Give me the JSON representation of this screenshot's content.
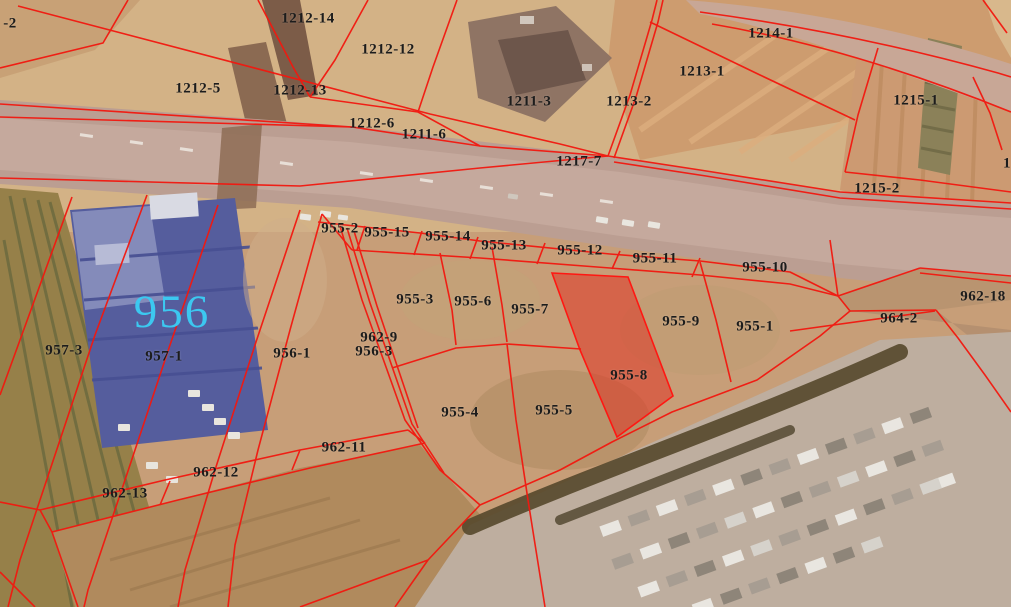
{
  "map": {
    "type": "cadastral-parcel-map-over-aerial-photo",
    "line_color": "#f2180f",
    "label_color": "#1c1c1c",
    "highlighted_parcel": "955-8",
    "highlight_fill": "#e03424",
    "area_label": {
      "text": "956",
      "color": "#3cc8f0",
      "x": 172,
      "y": 312
    },
    "labels": [
      {
        "text": "-2",
        "x": 10,
        "y": 24
      },
      {
        "text": "1212-14",
        "x": 308,
        "y": 19
      },
      {
        "text": "1212-12",
        "x": 388,
        "y": 50
      },
      {
        "text": "1212-5",
        "x": 198,
        "y": 89
      },
      {
        "text": "1212-13",
        "x": 300,
        "y": 91
      },
      {
        "text": "1212-6",
        "x": 372,
        "y": 124
      },
      {
        "text": "1211-6",
        "x": 424,
        "y": 135
      },
      {
        "text": "1211-3",
        "x": 529,
        "y": 102
      },
      {
        "text": "1213-2",
        "x": 629,
        "y": 102
      },
      {
        "text": "1213-1",
        "x": 702,
        "y": 72
      },
      {
        "text": "1214-1",
        "x": 771,
        "y": 34
      },
      {
        "text": "1215-1",
        "x": 916,
        "y": 101
      },
      {
        "text": "1217-7",
        "x": 579,
        "y": 162
      },
      {
        "text": "1215-2",
        "x": 877,
        "y": 189
      },
      {
        "text": "1",
        "x": 1007,
        "y": 164
      },
      {
        "text": "955-2",
        "x": 340,
        "y": 229
      },
      {
        "text": "955-15",
        "x": 387,
        "y": 233
      },
      {
        "text": "955-14",
        "x": 448,
        "y": 237
      },
      {
        "text": "955-13",
        "x": 504,
        "y": 246
      },
      {
        "text": "955-12",
        "x": 580,
        "y": 251
      },
      {
        "text": "955-11",
        "x": 655,
        "y": 259
      },
      {
        "text": "955-10",
        "x": 765,
        "y": 268
      },
      {
        "text": "955-3",
        "x": 415,
        "y": 300
      },
      {
        "text": "955-6",
        "x": 473,
        "y": 302
      },
      {
        "text": "955-7",
        "x": 530,
        "y": 310
      },
      {
        "text": "955-9",
        "x": 681,
        "y": 322
      },
      {
        "text": "955-1",
        "x": 755,
        "y": 327
      },
      {
        "text": "962-18",
        "x": 983,
        "y": 297
      },
      {
        "text": "964-2",
        "x": 899,
        "y": 319
      },
      {
        "text": "962-9",
        "x": 379,
        "y": 338
      },
      {
        "text": "956-3",
        "x": 374,
        "y": 352
      },
      {
        "text": "955-8",
        "x": 629,
        "y": 376
      },
      {
        "text": "955-4",
        "x": 460,
        "y": 413
      },
      {
        "text": "955-5",
        "x": 554,
        "y": 411
      },
      {
        "text": "957-3",
        "x": 64,
        "y": 351
      },
      {
        "text": "957-1",
        "x": 164,
        "y": 357
      },
      {
        "text": "956-1",
        "x": 292,
        "y": 354
      },
      {
        "text": "962-11",
        "x": 344,
        "y": 448
      },
      {
        "text": "962-12",
        "x": 216,
        "y": 473
      },
      {
        "text": "962-13",
        "x": 125,
        "y": 494
      }
    ]
  }
}
